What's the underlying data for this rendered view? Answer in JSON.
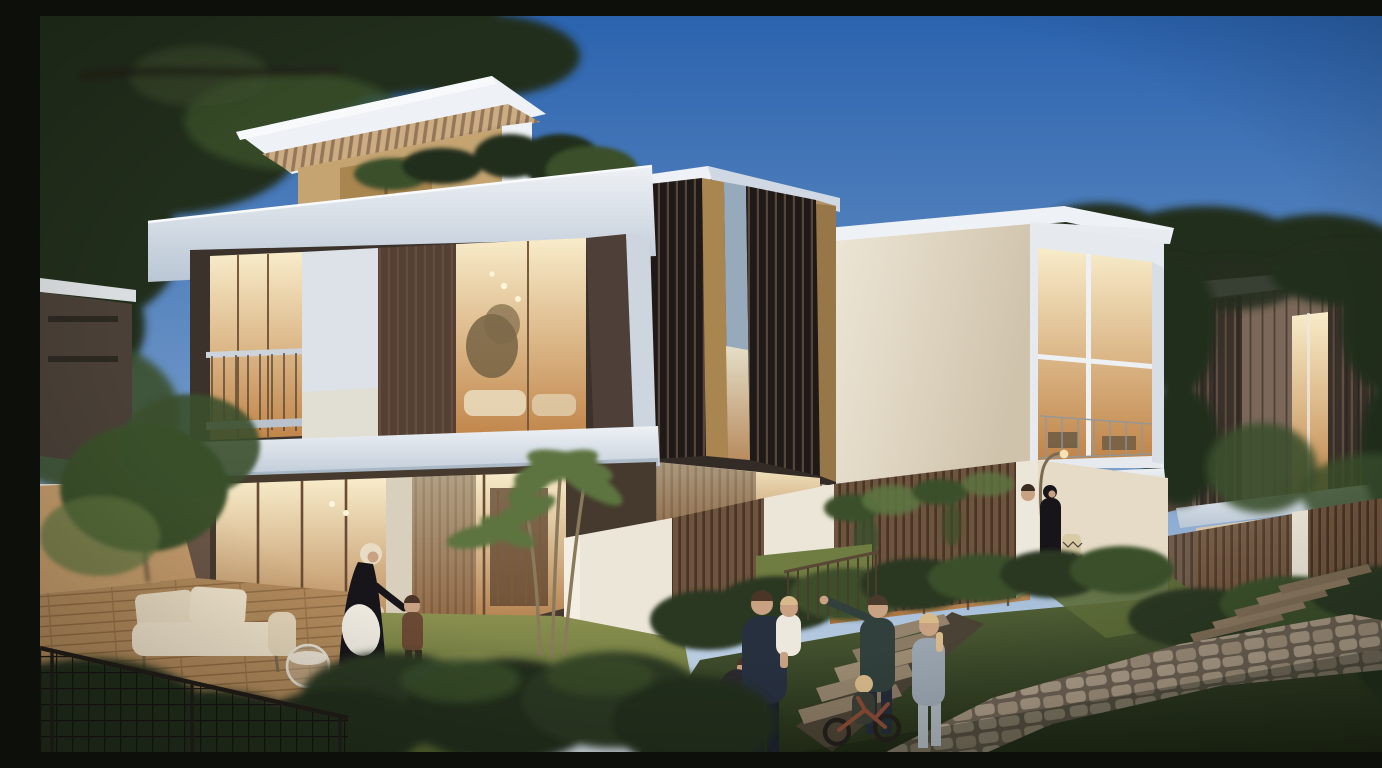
{
  "scene": {
    "type": "architectural-render",
    "time_of_day": "dusk",
    "caption": "Dusk 3D rendering of a modern villa community: two-storey white villas with bronze louvre screens and warm glowing interiors, landscaped gardens with lawns, hedges, timber fences, stone paths and steps, families gathered outdoors.",
    "people_count": 9
  },
  "palette": {
    "sky_top": "#2b63ae",
    "sky_mid": "#6e96c7",
    "sky_horizon": "#d7e1ea",
    "foliage_dark": "#222f1c",
    "foliage_mid": "#3a4f2b",
    "foliage_light": "#5d7340",
    "hedge": "#2c3823",
    "grass_light": "#8a9150",
    "grass_dark": "#3c4a2a",
    "slab_light": "#eef1f5",
    "slab_shade": "#b9c6d4",
    "wall_cream": "#e6dbc6",
    "wall_bright": "#ece6d8",
    "wood_light": "#c5a472",
    "wood_mid": "#a9854f",
    "wood_dark": "#6b5140",
    "louver_dark": "#1f1a17",
    "louver_lite": "#564639",
    "bronze": "#7b685a",
    "glow_hi": "#f8ecca",
    "glow_lo": "#c08448",
    "glow_deep": "#a96f3a",
    "glass_cool": "#97aabb",
    "deck": "#b18a5c",
    "deck_line": "#8f6b42",
    "fence_wood": "#6e543e",
    "fence_dark": "#463425",
    "stone": "#a69783",
    "stone_joint": "#6b6052",
    "step_stone": "#8a7a64",
    "metal": "#3a322a",
    "navy": "#27303f",
    "teal": "#31403c",
    "denim": "#9aa5b0",
    "white_cloth": "#ece8dd",
    "black_cloth": "#17151a",
    "skin": "#c9a183",
    "blond": "#d8b98a",
    "lamp": "#7a6a50"
  },
  "elements": {
    "villas": [
      {
        "id": "left-villa",
        "features": "rooftop pergola penthouse, white fascia slabs, lit living rooms on both floors, bronze timber panel, balcony"
      },
      {
        "id": "middle-villa",
        "features": "dark vertical louvre screens over warm glazing"
      },
      {
        "id": "right-villa",
        "features": "large pale feature wall, glazed corner lounge with balcony"
      },
      {
        "id": "far-right-villa",
        "features": "bronze clad volume with louvres between trees"
      }
    ],
    "landscape": [
      "lawns",
      "clipped hedges",
      "timber slat fences with ivy",
      "white garden walls",
      "flagstone path",
      "garden steps",
      "timber deck with outdoor sofa",
      "palm tree",
      "mature trees"
    ],
    "people": [
      {
        "id": "abaya-woman",
        "desc": "woman in black abaya with white bag greeting a toddler"
      },
      {
        "id": "toddler-left",
        "desc": "toddler in brown dress"
      },
      {
        "id": "father",
        "desc": "man in navy holding a toddler in white"
      },
      {
        "id": "seated-child",
        "desc": "child crouching by the hedge"
      },
      {
        "id": "pointing-woman",
        "desc": "woman in dark green pointing toward the villa"
      },
      {
        "id": "standing-woman",
        "desc": "woman in grey top and light jeans"
      },
      {
        "id": "bike-child",
        "desc": "child on a balance bike"
      },
      {
        "id": "kandura-man",
        "desc": "man in white kandura by garden wall"
      },
      {
        "id": "abaya-woman-2",
        "desc": "woman in black abaya by garden wall"
      }
    ]
  }
}
